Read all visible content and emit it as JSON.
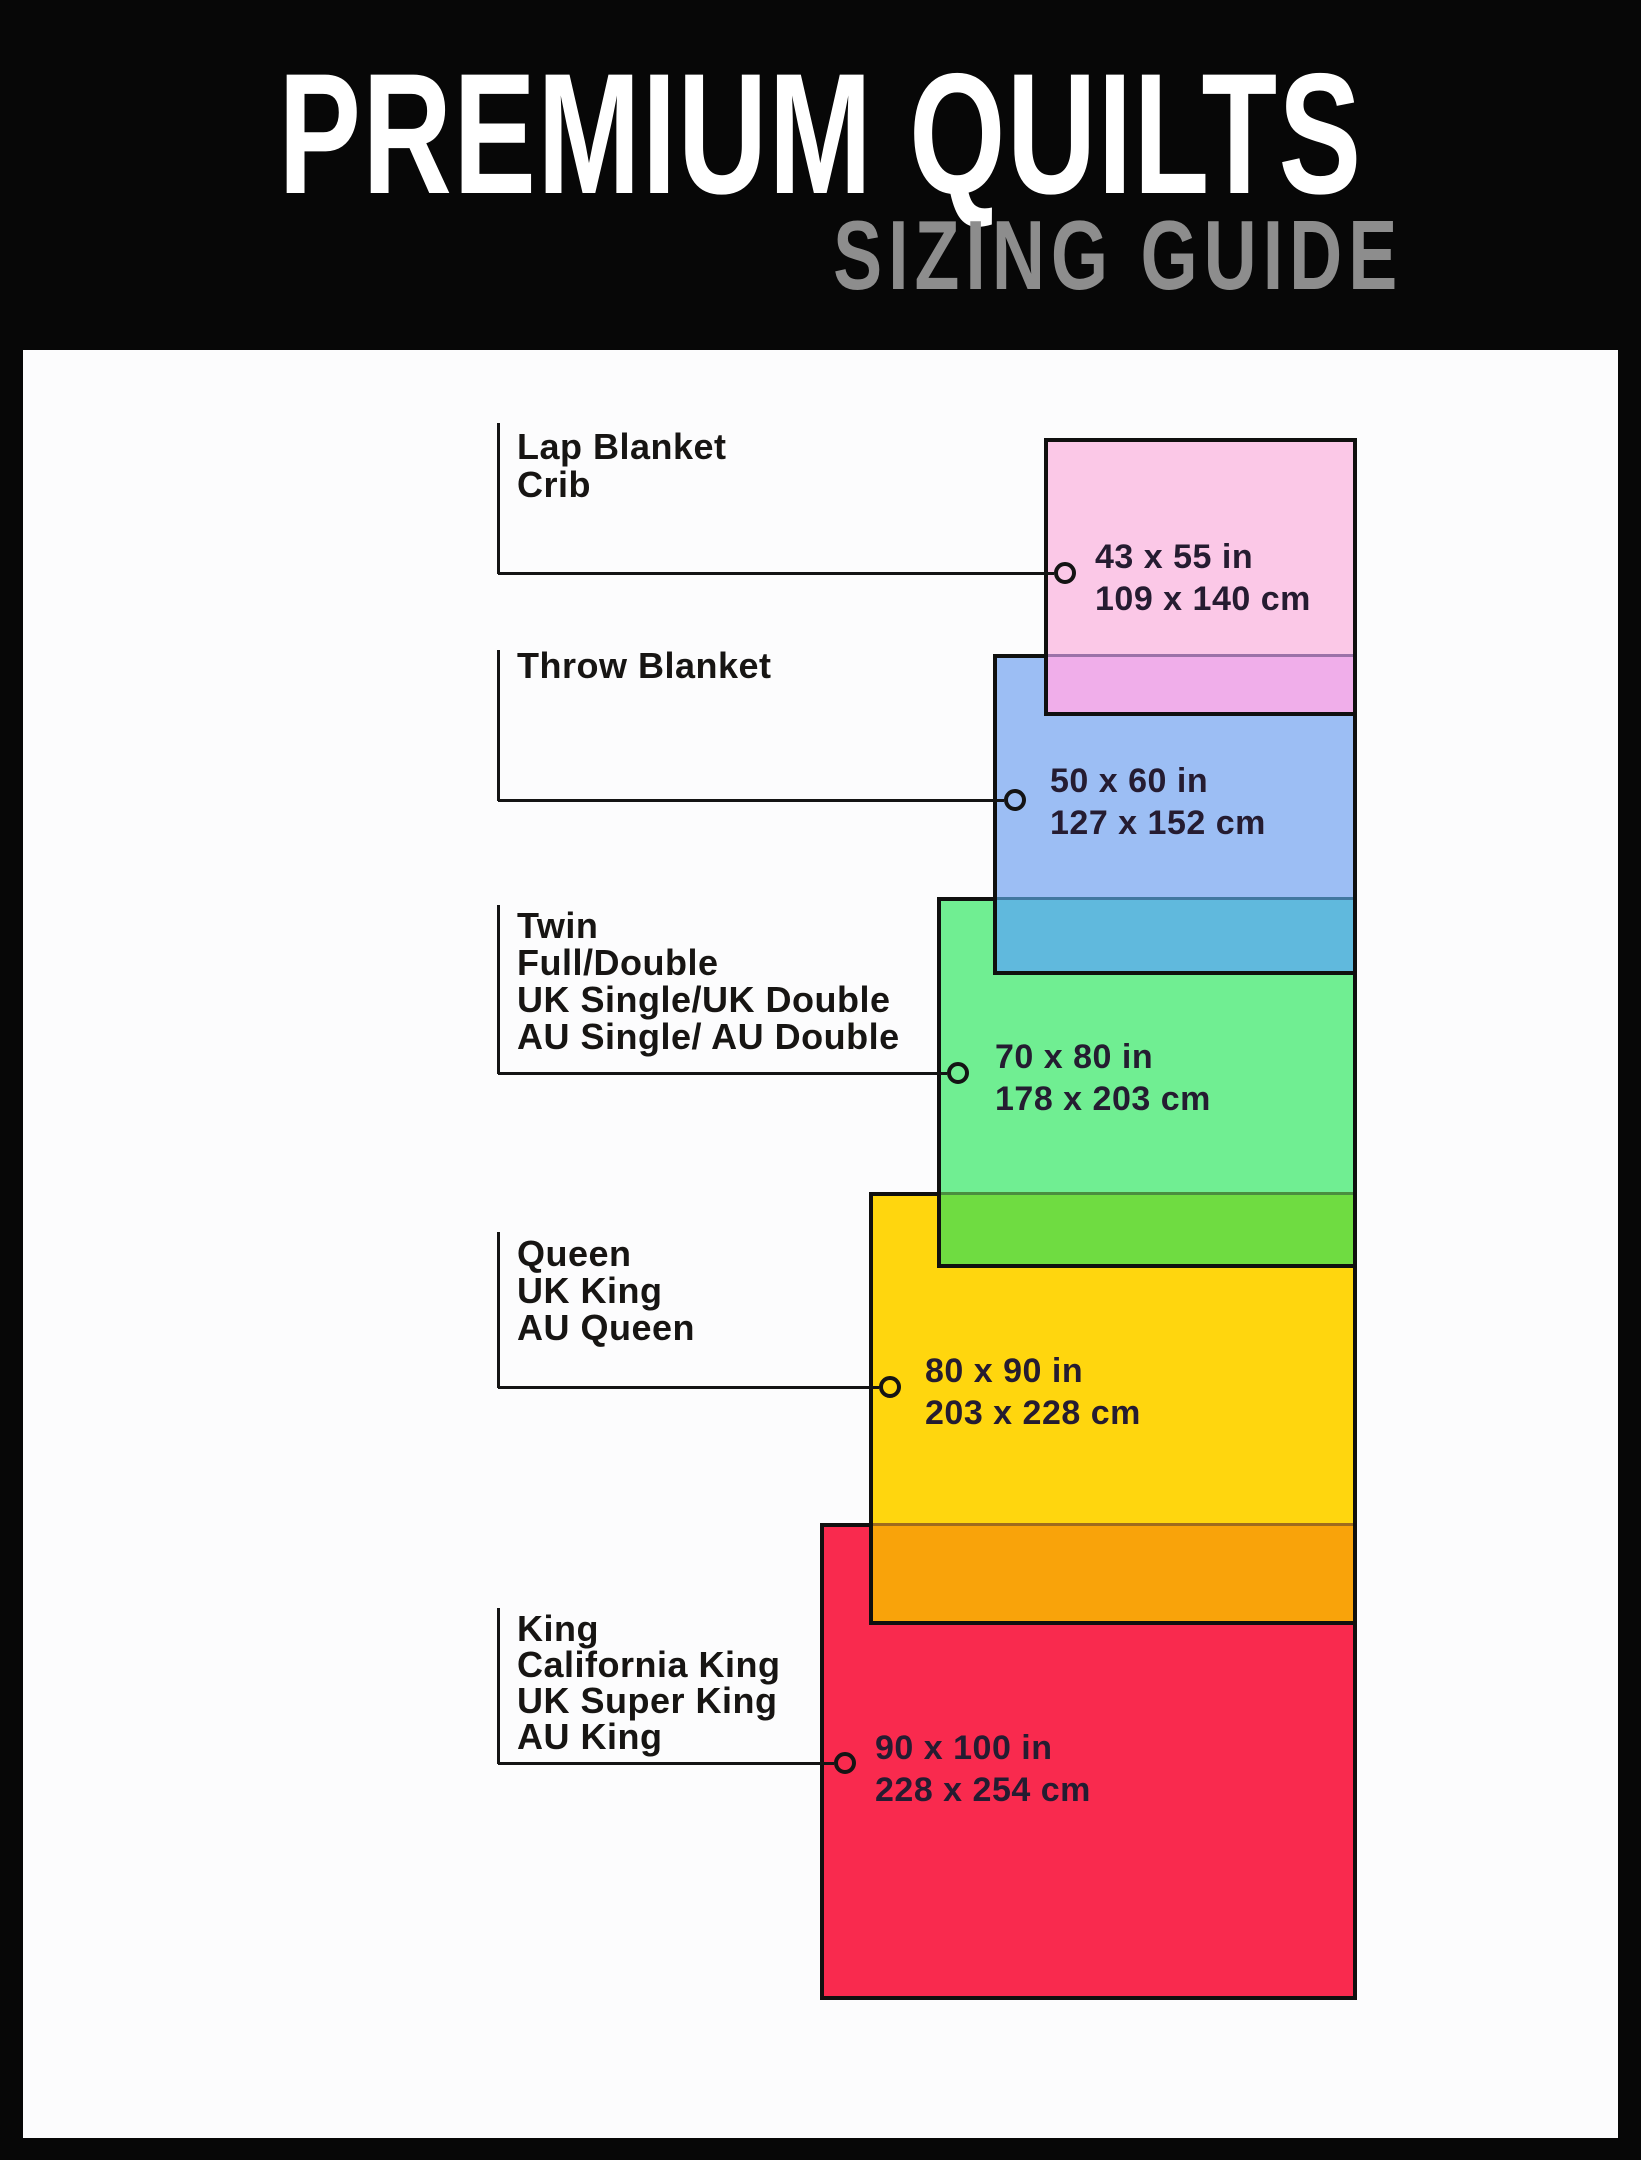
{
  "header": {
    "title": "PREMIUM QUILTS",
    "subtitle": "SIZING GUIDE"
  },
  "colors": {
    "pageBg": "#070707",
    "panelBg": "#fcfcfd",
    "titleColor": "#ffffff",
    "subtitleColor": "#8d8d8d",
    "outline": "#10100f",
    "lineColor": "#141414",
    "labelColor": "#171513",
    "sizeTextColor": "#251c31",
    "pink": "#fbc8e7",
    "pinkOverlap": "#f0aeea",
    "blue": "#9cbef4",
    "blueOverlap": "#60b9dd",
    "green": "#70ee92",
    "greenOverlap": "#6fdc41",
    "yellow": "#ffd60e",
    "yellowOverlap": "#f9a30a",
    "red": "#f92a4e"
  },
  "chart_data": {
    "type": "table",
    "title": "Premium Quilts Sizing Guide",
    "columns": [
      "Bed / blanket types",
      "Size (in)",
      "Size (cm)"
    ],
    "rows": [
      {
        "types": [
          "Lap Blanket",
          "Crib"
        ],
        "inches": "43 x 55 in",
        "cm": "109 x 140 cm",
        "color": "#fbc8e7"
      },
      {
        "types": [
          "Throw Blanket"
        ],
        "inches": "50 x 60 in",
        "cm": "127 x 152 cm",
        "color": "#9cbef4"
      },
      {
        "types": [
          "Twin",
          "Full/Double",
          "UK Single/UK Double",
          "AU Single/ AU Double"
        ],
        "inches": "70 x 80 in",
        "cm": "178 x 203 cm",
        "color": "#70ee92"
      },
      {
        "types": [
          "Queen",
          "UK King",
          "AU Queen"
        ],
        "inches": "80 x 90 in",
        "cm": "203 x 228 cm",
        "color": "#ffd60e"
      },
      {
        "types": [
          "King",
          "California King",
          "UK Super King",
          "AU King"
        ],
        "inches": "90 x 100 in",
        "cm": "228 x 254 cm",
        "color": "#f92a4e"
      }
    ]
  },
  "sizes": [
    {
      "labels": [
        "Lap Blanket",
        "Crib"
      ],
      "inches": "43 x 55 in",
      "cm": "109 x 140 cm"
    },
    {
      "labels": [
        "Throw Blanket"
      ],
      "inches": "50 x 60 in",
      "cm": "127 x 152 cm"
    },
    {
      "labels": [
        "Twin",
        "Full/Double",
        "UK Single/UK Double",
        "AU Single/ AU Double"
      ],
      "inches": "70 x 80 in",
      "cm": "178 x 203 cm"
    },
    {
      "labels": [
        "Queen",
        "UK King",
        "AU Queen"
      ],
      "inches": "80 x 90 in",
      "cm": "203 x 228 cm"
    },
    {
      "labels": [
        "King",
        "California King",
        "UK Super King",
        "AU King"
      ],
      "inches": "90 x 100 in",
      "cm": "228 x 254 cm"
    }
  ]
}
